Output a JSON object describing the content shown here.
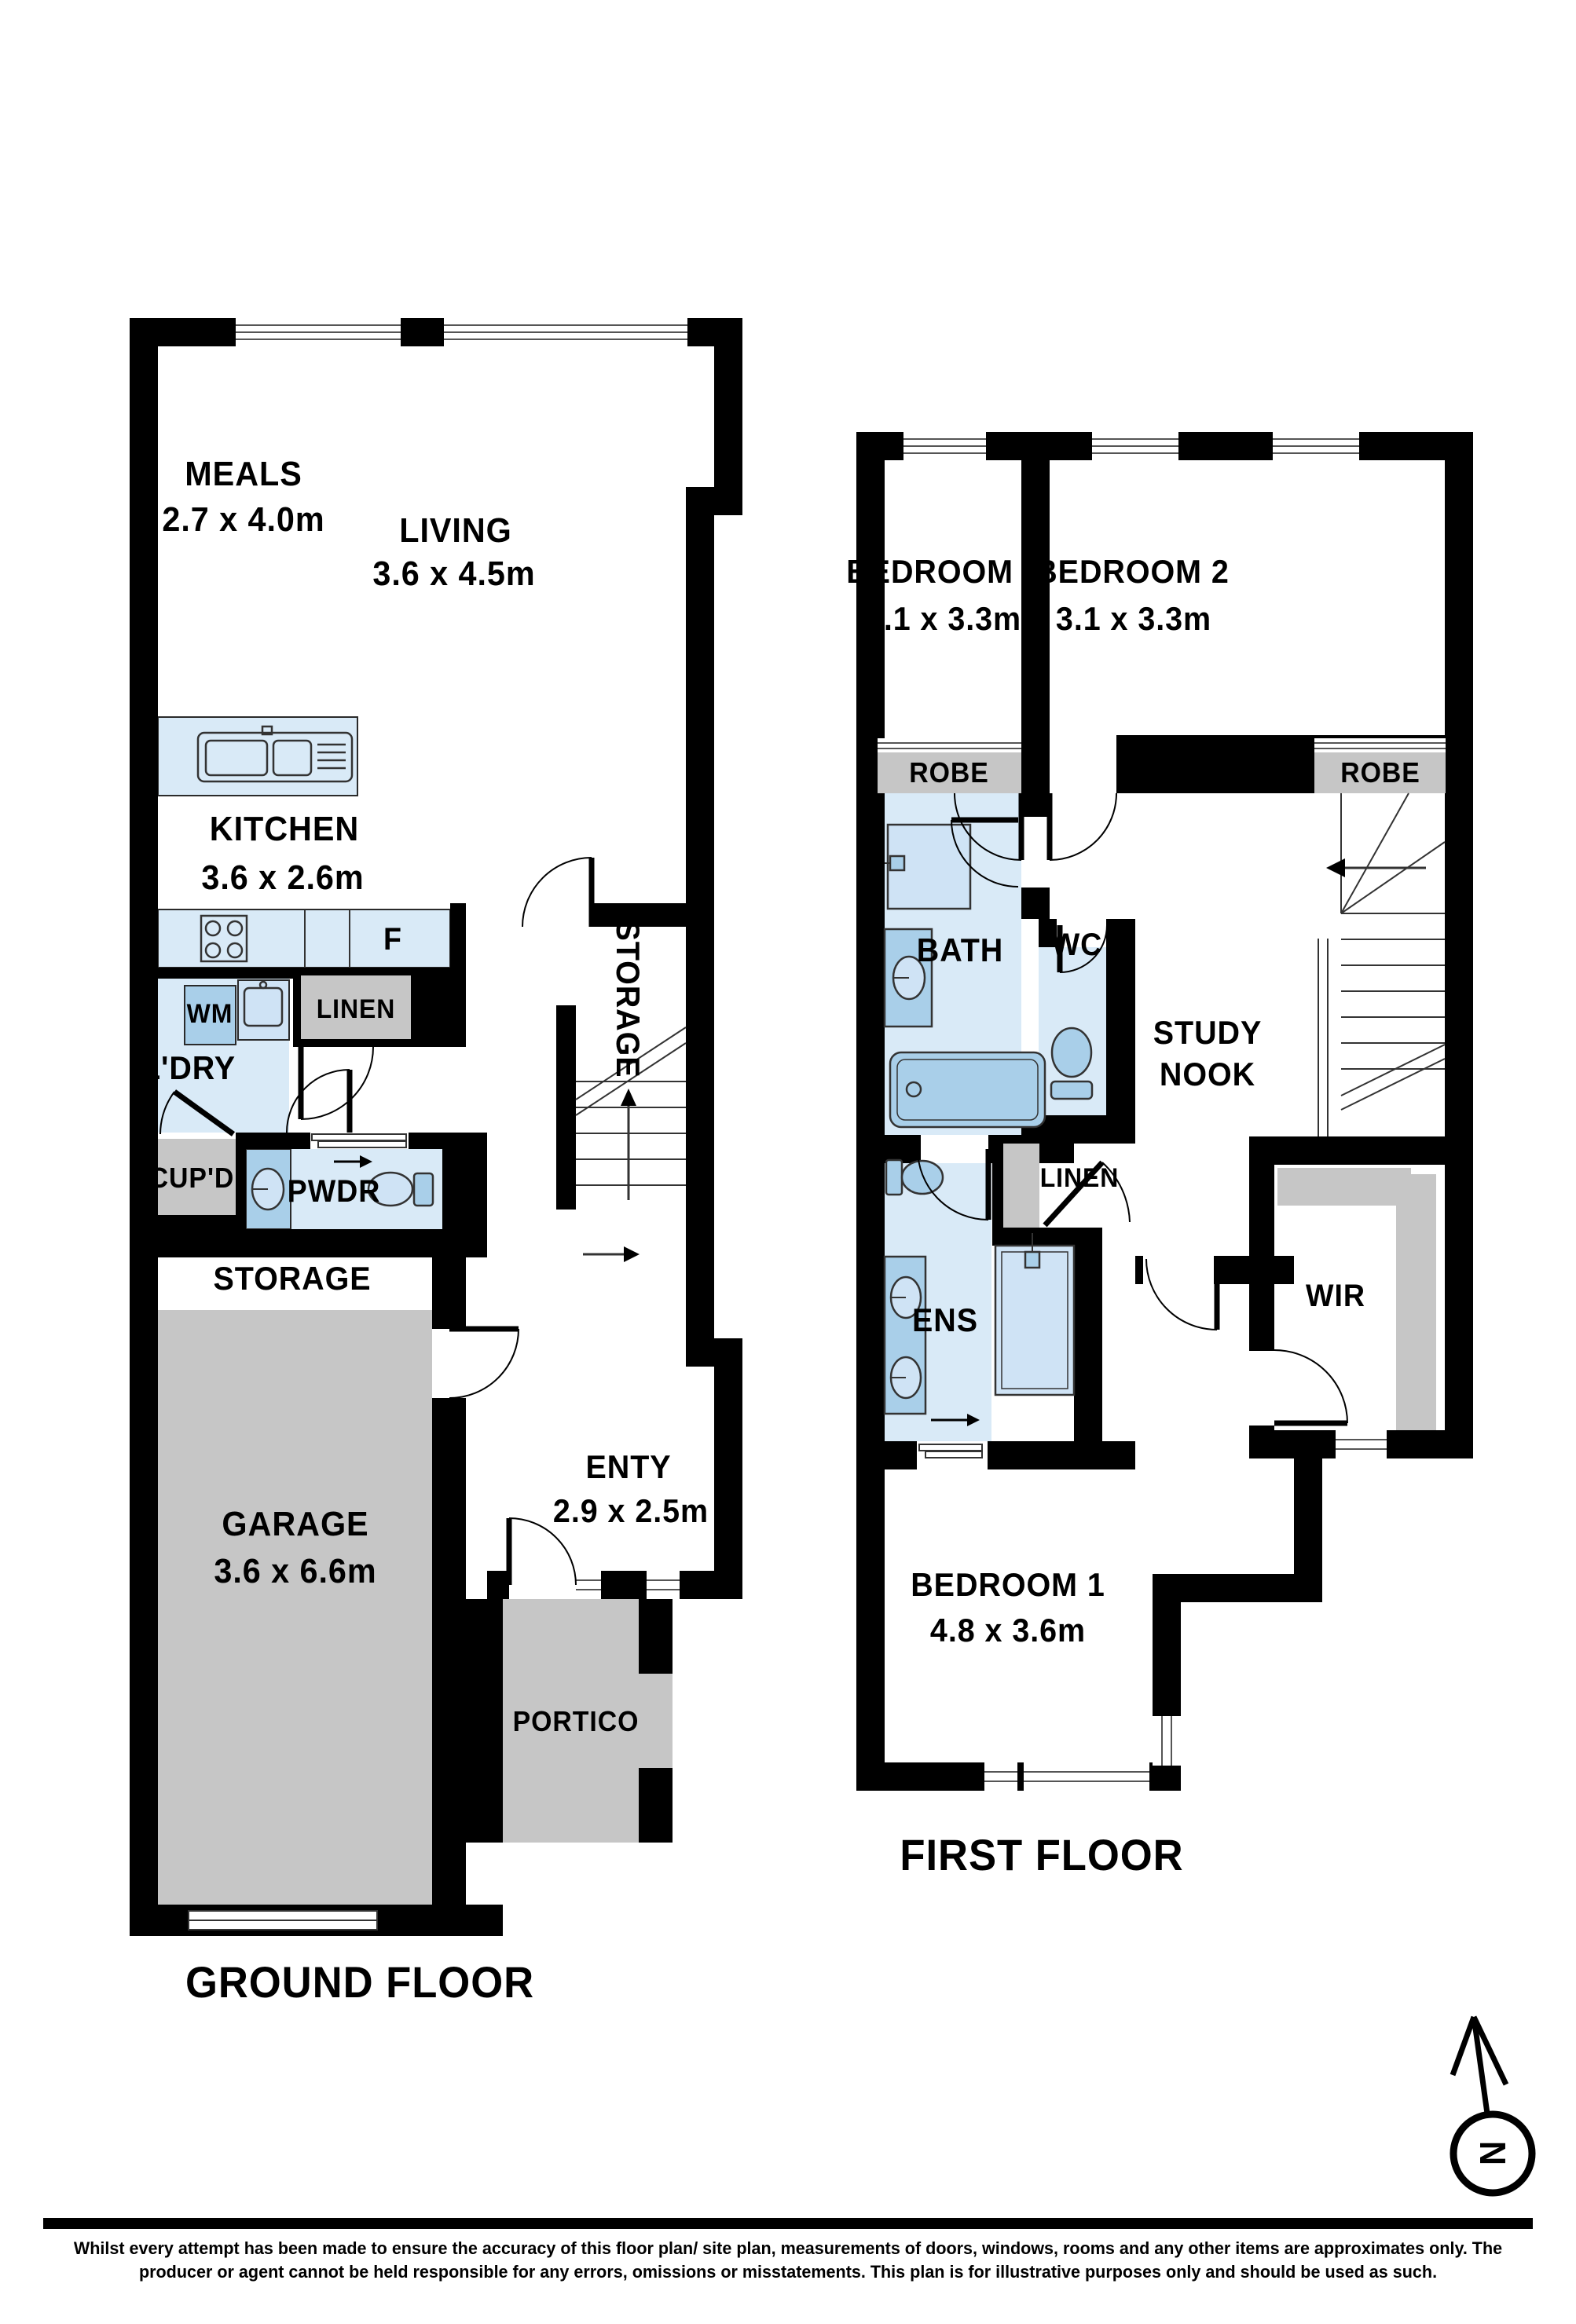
{
  "colors": {
    "wall": "#000000",
    "room_blue": "#d9eaf7",
    "fixture_blue": "#a9cfe9",
    "fixture_light": "#cfe3f5",
    "gray": "#c6c6c6",
    "background": "#ffffff"
  },
  "ground_floor": {
    "title": "GROUND FLOOR",
    "meals": {
      "name": "MEALS",
      "dims": "2.7 x 4.0m"
    },
    "living": {
      "name": "LIVING",
      "dims": "3.6 x 4.5m"
    },
    "kitchen": {
      "name": "KITCHEN",
      "dims": "3.6 x 2.6m"
    },
    "fridge": "F",
    "wm": "WM",
    "laundry": "L'DRY",
    "linen": "LINEN",
    "cupboard": "CUP'D",
    "powder": "PWDR",
    "storage_hall": "STORAGE",
    "storage_stairs": "STORAGE",
    "entry": {
      "name": "ENTY",
      "dims": "2.9 x 2.5m"
    },
    "garage": {
      "name": "GARAGE",
      "dims": "3.6 x 6.6m"
    },
    "portico": "PORTICO"
  },
  "first_floor": {
    "title": "FIRST FLOOR",
    "bedroom3": {
      "name": "BEDROOM 3",
      "dims": "3.1 x 3.3m"
    },
    "bedroom2": {
      "name": "BEDROOM 2",
      "dims": "3.1 x 3.3m"
    },
    "robe3": "ROBE",
    "robe2": "ROBE",
    "bath": "BATH",
    "wc": "WC",
    "study_nook": {
      "line1": "STUDY",
      "line2": "NOOK"
    },
    "linen": "LINEN",
    "ens": "ENS",
    "wir": "WIR",
    "bedroom1": {
      "name": "BEDROOM 1",
      "dims": "4.8 x 3.6m"
    }
  },
  "compass": {
    "letter": "N"
  },
  "disclaimer": {
    "line1": "Whilst every attempt has been made to ensure the accuracy of this floor plan/ site plan, measurements of doors, windows, rooms and any other items are approximates only. The",
    "line2": "producer or agent cannot be held responsible for any errors, omissions or misstatements. This plan is for illustrative purposes only and should be used as such."
  }
}
